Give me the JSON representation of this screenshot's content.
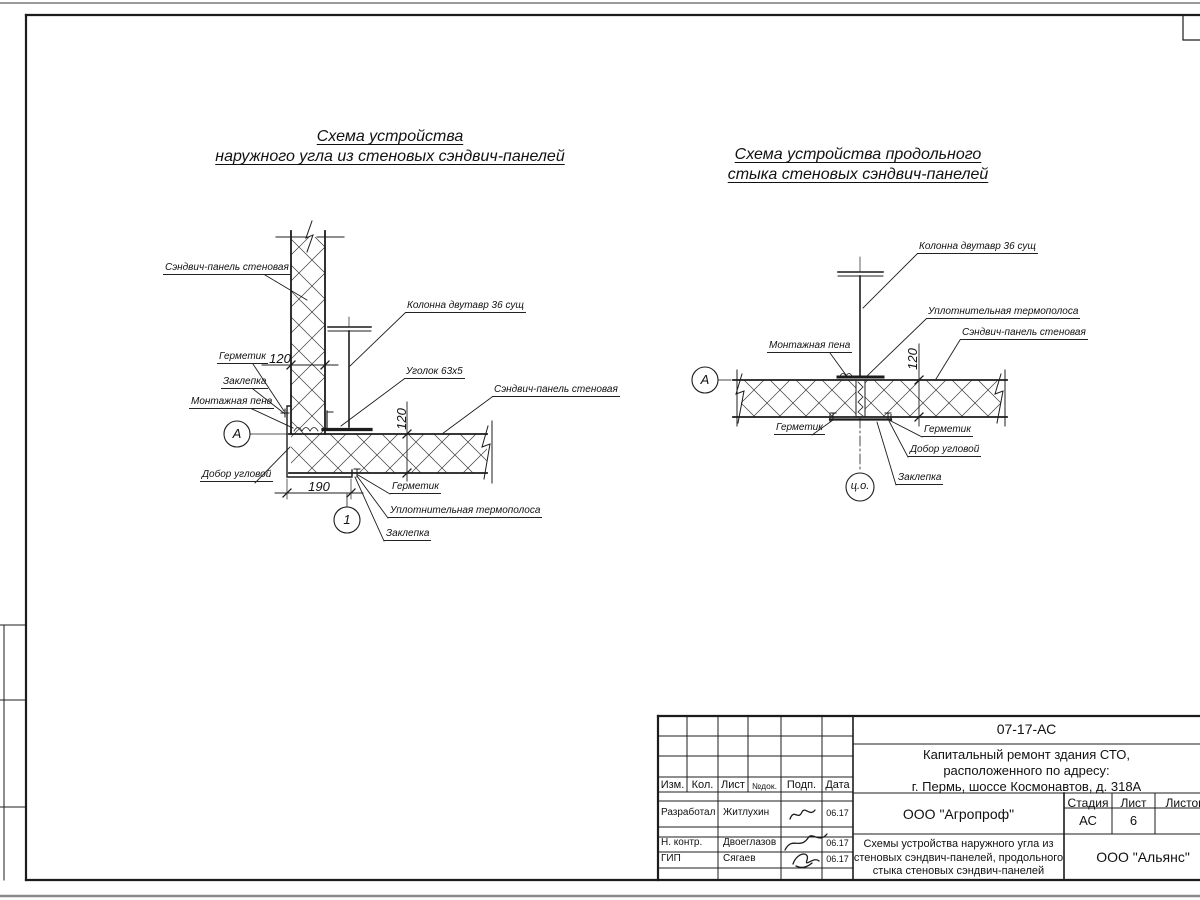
{
  "diagram_left": {
    "title_line1": "Схема устройства",
    "title_line2": "наружного угла из стеновых сэндвич-панелей",
    "labels": {
      "panel_top": "Сэндвич-панель стеновая",
      "column": "Колонна двутавр 36 сущ",
      "angle": "Уголок 63х5",
      "panel_right": "Сэндвич-панель стеновая",
      "sealant_left": "Герметик",
      "rivet_left": "Заклепка",
      "foam": "Монтажная пена",
      "corner_trim": "Добор угловой",
      "sealant_bottom": "Герметик",
      "thermo": "Уплотнительная термополоса",
      "rivet_bottom": "Заклепка",
      "dim_120_h": "120",
      "dim_120_v": "120",
      "dim_190": "190",
      "marker_a": "А",
      "marker_1": "1"
    }
  },
  "diagram_right": {
    "title_line1": "Схема устройства продольного",
    "title_line2": "стыка стеновых сэндвич-панелей",
    "labels": {
      "column": "Колонна двутавр 36 сущ",
      "thermo": "Уплотнительная термополоса",
      "panel": "Сэндвич-панель стеновая",
      "foam": "Монтажная пена",
      "sealant_left": "Герметик",
      "sealant_right": "Герметик",
      "corner_trim": "Добор угловой",
      "rivet": "Заклепка",
      "dim_120": "120",
      "marker_a": "А",
      "marker_co": "ц.о."
    }
  },
  "title_block": {
    "doc_number": "07-17-АС",
    "project_line1": "Капитальный ремонт здания СТО,",
    "project_line2": "расположенного по адресу:",
    "project_line3": "г. Пермь, шоссе Космонавтов, д. 318А",
    "developer_org": "ООО \"Агропроф\"",
    "sheet_title_line1": "Схемы устройства наружного угла из",
    "sheet_title_line2": "стеновых сэндвич-панелей, продольного",
    "sheet_title_line3": "стыка стеновых сэндвич-панелей",
    "contractor_org": "ООО \"Альянс\"",
    "col_izm": "Изм.",
    "col_kol": "Кол.",
    "col_list": "Лист",
    "col_ndok": "№док.",
    "col_podp": "Подп.",
    "col_data": "Дата",
    "stage_label": "Стадия",
    "sheet_label": "Лист",
    "sheets_label": "Листов",
    "stage_value": "АС",
    "sheet_value": "6",
    "rows": [
      {
        "role": "Разработал",
        "name": "Житлухин",
        "date": "06.17"
      },
      {
        "role": "Н. контр.",
        "name": "Двоеглазов",
        "date": "06.17"
      },
      {
        "role": "ГИП",
        "name": "Сягаев",
        "date": "06.17"
      }
    ]
  }
}
